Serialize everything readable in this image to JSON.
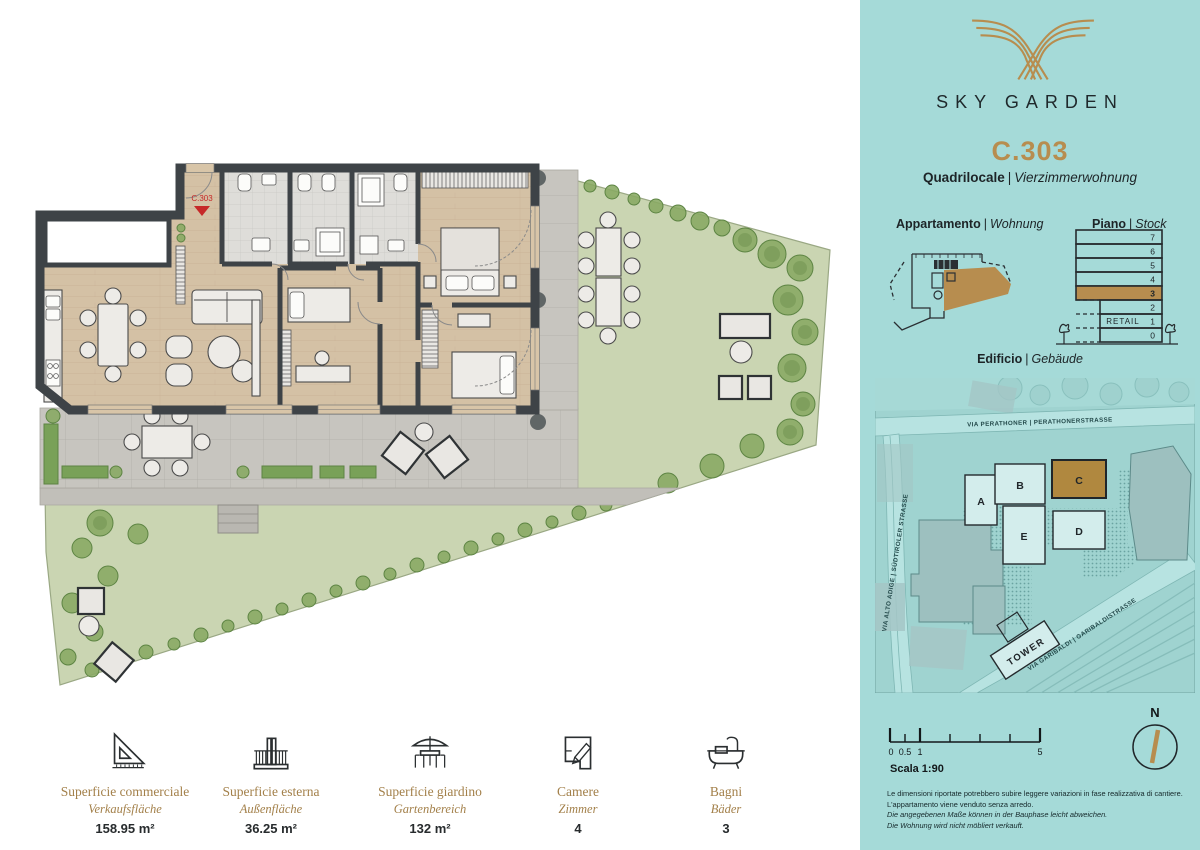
{
  "ui": {
    "sep": "|"
  },
  "brand": {
    "name": "SKY GARDEN"
  },
  "unit": {
    "code": "C.303",
    "type_it": "Quadrilocale",
    "type_de": "Vierzimmerwohnung",
    "marker": "C.303"
  },
  "sections": {
    "apartment_it": "Appartamento",
    "apartment_de": "Wohnung",
    "floor_it": "Piano",
    "floor_de": "Stock",
    "building_it": "Edificio",
    "building_de": "Gebäude"
  },
  "floor_stack": {
    "floors": [
      "7",
      "6",
      "5",
      "4",
      "3",
      "2",
      "1",
      "0"
    ],
    "highlighted_floor": "3",
    "retail_label": "RETAIL"
  },
  "site_map": {
    "streets": [
      {
        "label": "VIA PERATHONER | PERATHONERSTRASSE"
      },
      {
        "label": "VIA ALTO ADIGE | SÜDTIROLER STRASSE"
      },
      {
        "label": "VIA GARIBALDI | GARIBALDISTRASSE"
      }
    ],
    "buildings": [
      "A",
      "B",
      "C",
      "D",
      "E"
    ],
    "highlighted_building": "C",
    "tower_label": "TOWER"
  },
  "scale_bar": {
    "label": "Scala 1:90",
    "ticks": [
      "0",
      "0.5",
      "1",
      "5"
    ]
  },
  "compass": {
    "label": "N"
  },
  "disclaimer": {
    "it1": "Le dimensioni riportate potrebbero subire leggere variazioni in fase realizzativa di cantiere.",
    "it2": "L'appartamento viene venduto senza arredo.",
    "de1": "Die angegebenen Maße können in der Bauphase leicht abweichen.",
    "de2": "Die Wohnung wird nicht möbliert verkauft."
  },
  "stats": [
    {
      "icon": "set-square-icon",
      "label_it": "Superficie commerciale",
      "label_de": "Verkaufsfläche",
      "value": "158.95 m²"
    },
    {
      "icon": "balcony-icon",
      "label_it": "Superficie esterna",
      "label_de": "Außenfläche",
      "value": "36.25 m²"
    },
    {
      "icon": "garden-table-icon",
      "label_it": "Superficie giardino",
      "label_de": "Gartenbereich",
      "value": "132 m²"
    },
    {
      "icon": "floorplan-pencil-icon",
      "label_it": "Camere",
      "label_de": "Zimmer",
      "value": "4"
    },
    {
      "icon": "bathtub-icon",
      "label_it": "Bagni",
      "label_de": "Bäder",
      "value": "3"
    }
  ],
  "colors": {
    "teal": "#a5dad8",
    "gold": "#b78d4f",
    "dark": "#20262a",
    "grass": "#cad5b2",
    "wood": "#d4c1a5",
    "wall": "#3e4347",
    "marker_red": "#c62828"
  }
}
